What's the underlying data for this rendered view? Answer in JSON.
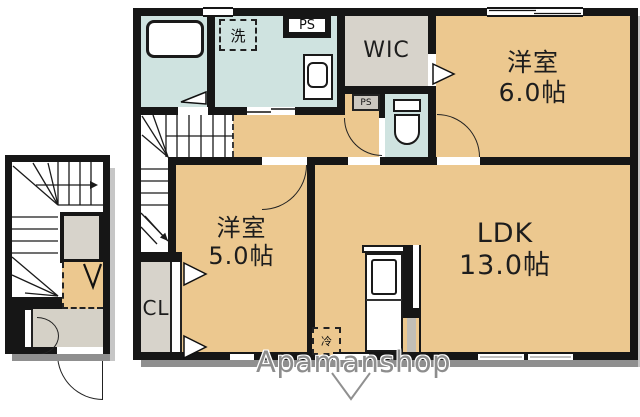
{
  "colors": {
    "tan": "#ecc88f",
    "lightblue": "#cfe3e0",
    "grey": "#d7d3cb",
    "greyfloor": "#d5d1c7",
    "grey2": "#cbc7c0",
    "wall": "#161616",
    "shadow": "#8f8f8f",
    "shadow2": "#c6c6c6"
  },
  "rooms": {
    "bedroom6": {
      "name": "洋室",
      "size": "6.0帖"
    },
    "bedroom5": {
      "name": "洋室",
      "size": "5.0帖"
    },
    "ldk": {
      "name": "LDK",
      "size": "13.0帖"
    },
    "wic": {
      "name": "WIC"
    },
    "closet": {
      "name": "CL"
    }
  },
  "labels": {
    "pipe_space_top": "PS",
    "pipe_space_small": "PS",
    "washing_machine": "洗",
    "refrigerator": "冷"
  },
  "watermark": {
    "text": "Apamanshop"
  }
}
